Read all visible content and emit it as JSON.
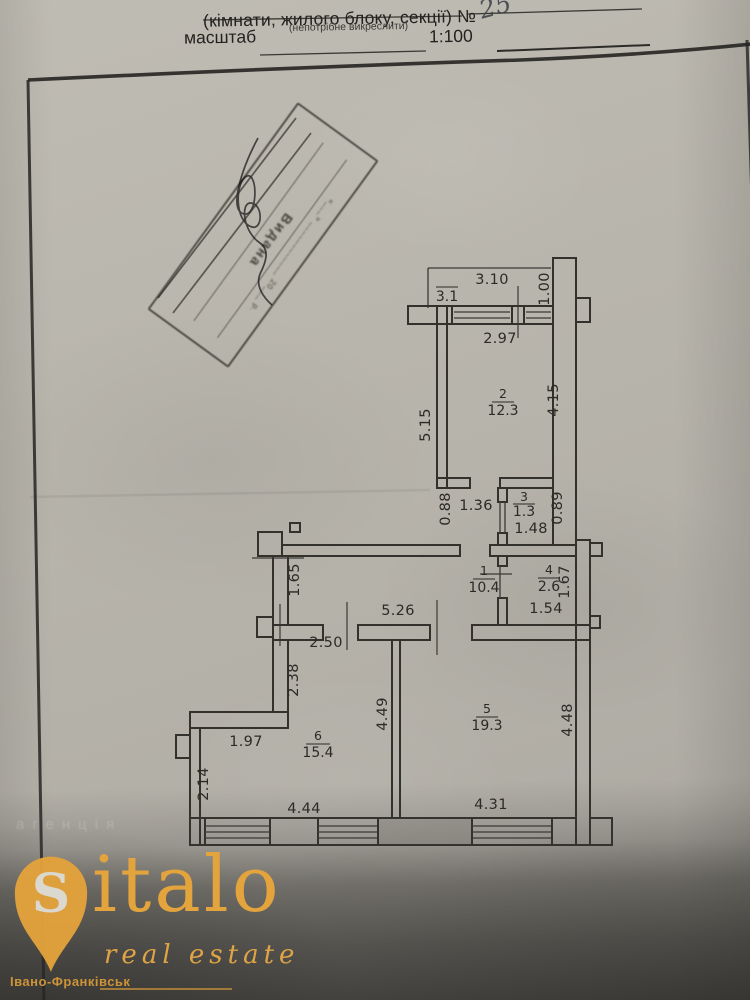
{
  "form": {
    "title_line": "(кімнати, жилого блоку, секції)",
    "number_sign": "№",
    "number_value": "25",
    "subtitle": "(непотрібне викреслити)",
    "scale_label": "масштаб",
    "scale_value": "1:100"
  },
  "stamp": {
    "line_main": "Видана",
    "line_date": "«___» ____________ 20___ р."
  },
  "plan": {
    "balcony_area": "3.1",
    "rooms": {
      "r1": {
        "num": "1",
        "area": "10.4"
      },
      "r2": {
        "num": "2",
        "area": "12.3"
      },
      "r3": {
        "num": "3",
        "area": "1.3"
      },
      "r4": {
        "num": "4",
        "area": "2.6"
      },
      "r5": {
        "num": "5",
        "area": "19.3"
      },
      "r6": {
        "num": "6",
        "area": "15.4"
      }
    },
    "dims": {
      "d310": "3.10",
      "d100": "1.00",
      "d297": "2.97",
      "d515": "5.15",
      "d415": "4.15",
      "d088": "0.88",
      "d136": "1.36",
      "d089": "0.89",
      "d148": "1.48",
      "d165": "1.65",
      "d526": "5.26",
      "d250": "2.50",
      "d167": "1.67",
      "d154": "1.54",
      "d238": "2.38",
      "d197": "1.97",
      "d214": "2.14",
      "d449": "4.49",
      "d448": "4.48",
      "d444": "4.44",
      "d431": "4.31"
    }
  },
  "watermark": {
    "faint_text": "агенція"
  },
  "logo": {
    "pin_letter": "S",
    "brand_rest": "italo",
    "tagline": "real estate",
    "city": "Івано-Франківськ"
  },
  "colors": {
    "gold": "#e2a23c",
    "ink": "#2b2a26",
    "paper": "#b6b3aa"
  }
}
